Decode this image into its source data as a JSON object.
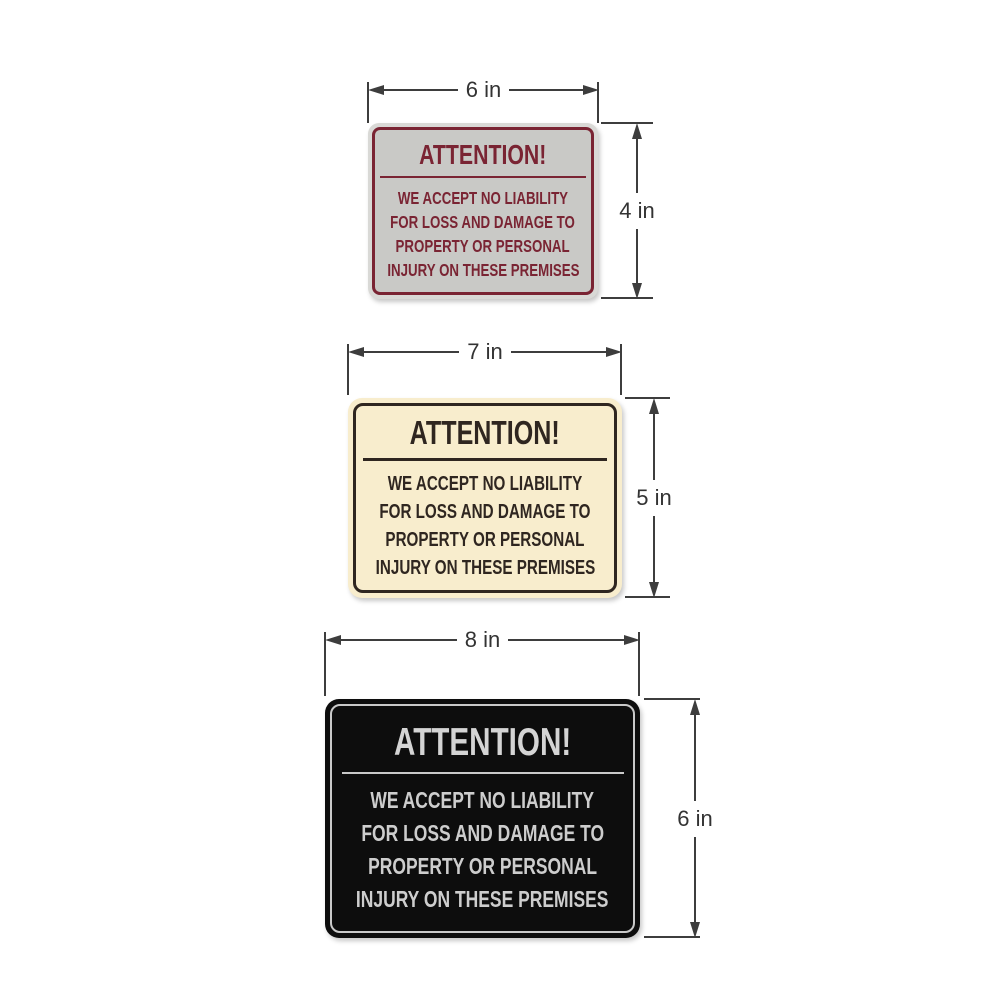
{
  "page": {
    "background_color": "#ffffff",
    "dimension_line_color": "#3d3d3d",
    "dimension_label_color": "#333333"
  },
  "signs": [
    {
      "id": "gray-sign-6x4",
      "title": "ATTENTION!",
      "body_lines": [
        "WE ACCEPT NO LIABILITY",
        "FOR LOSS AND DAMAGE TO",
        "PROPERTY OR PERSONAL",
        "INJURY ON THESE PREMISES"
      ],
      "width_label": "6 in",
      "height_label": "4 in",
      "colors": {
        "plate_edge": "#d9d9d6",
        "background": "#c9c9c6",
        "border": "#7a2433",
        "text": "#7a2433"
      }
    },
    {
      "id": "ivory-sign-7x5",
      "title": "ATTENTION!",
      "body_lines": [
        "WE ACCEPT NO LIABILITY",
        "FOR LOSS AND DAMAGE TO",
        "PROPERTY OR PERSONAL",
        "INJURY ON THESE PREMISES"
      ],
      "width_label": "7 in",
      "height_label": "5 in",
      "colors": {
        "plate_edge": "#f8edcd",
        "background": "#f8edcd",
        "border": "#2f2620",
        "text": "#2f2620"
      }
    },
    {
      "id": "black-sign-8x6",
      "title": "ATTENTION!",
      "body_lines": [
        "WE ACCEPT NO LIABILITY",
        "FOR LOSS AND DAMAGE TO",
        "PROPERTY OR PERSONAL",
        "INJURY ON THESE PREMISES"
      ],
      "width_label": "8 in",
      "height_label": "6 in",
      "colors": {
        "plate_edge": "#0d0d0d",
        "background": "#0d0d0d",
        "border": "#c9c9c9",
        "text": "#cdcdcd"
      }
    }
  ]
}
